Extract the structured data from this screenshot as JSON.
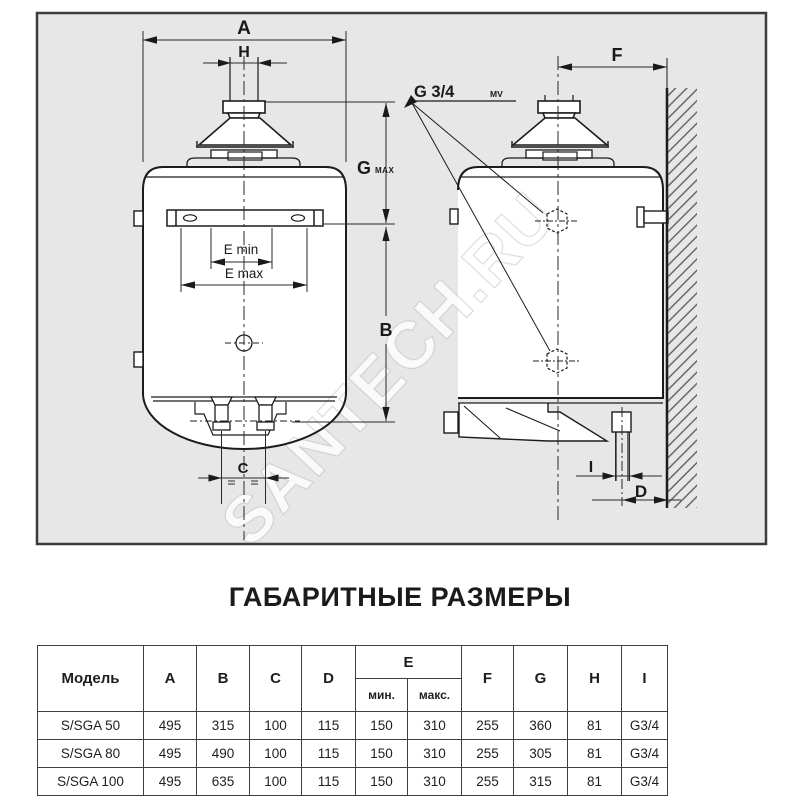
{
  "title": "ГАБАРИТНЫЕ РАЗМЕРЫ",
  "watermark": {
    "main": "SANTECH.RU",
    "table_ghost": "SANTECH.RU"
  },
  "colors": {
    "frame_background": "#e7e7e7",
    "frame_border": "#3c3c3c",
    "line": "#1c1c1c",
    "watermark": "#ffffff",
    "table_border": "#3f3f3f"
  },
  "diagram": {
    "labels": {
      "a": "A",
      "h": "H",
      "g": "G",
      "g_sub": "MAX",
      "e_min": "E min",
      "e_max": "E max",
      "b": "B",
      "c": "C",
      "f": "F",
      "i": "I",
      "d": "D",
      "thread": "G 3/4",
      "thread_sub": "MV"
    }
  },
  "table": {
    "headers": {
      "model": "Модель",
      "a": "A",
      "b": "B",
      "c": "C",
      "d": "D",
      "e": "E",
      "e_min": "мин.",
      "e_max": "макс.",
      "f": "F",
      "g": "G",
      "h": "H",
      "i": "I"
    },
    "rows": [
      {
        "model": "S/SGA 50",
        "values": [
          "495",
          "315",
          "100",
          "115",
          "150",
          "310",
          "255",
          "360",
          "81",
          "G3/4"
        ]
      },
      {
        "model": "S/SGA 80",
        "values": [
          "495",
          "490",
          "100",
          "115",
          "150",
          "310",
          "255",
          "305",
          "81",
          "G3/4"
        ]
      },
      {
        "model": "S/SGA 100",
        "values": [
          "495",
          "635",
          "100",
          "115",
          "150",
          "310",
          "255",
          "315",
          "81",
          "G3/4"
        ]
      }
    ]
  }
}
